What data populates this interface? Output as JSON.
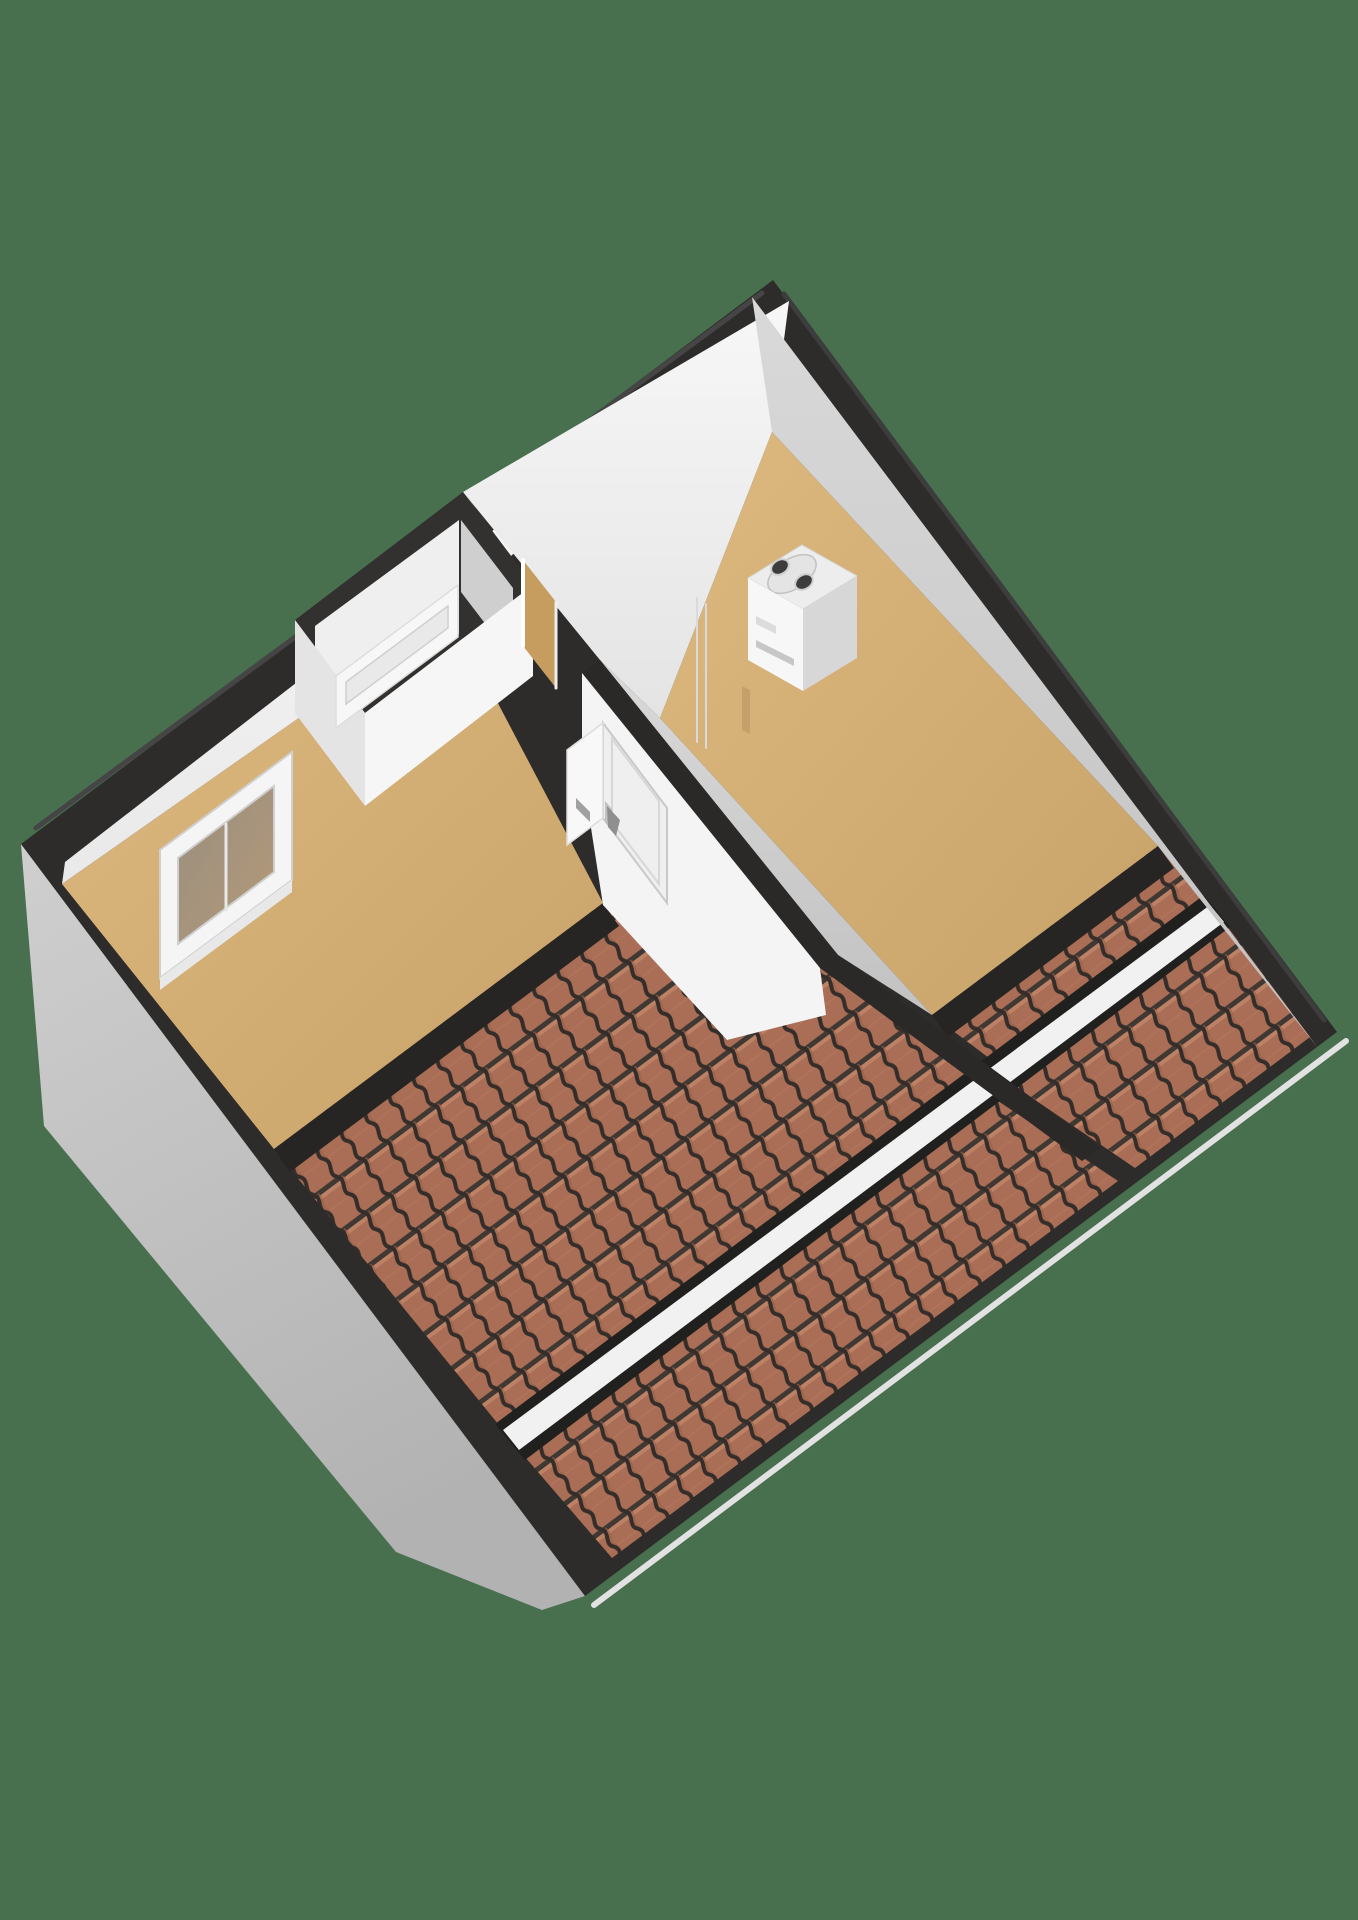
{
  "meta": {
    "description": "3D axonometric attic floor plan render on green background",
    "background_color": "#48704e"
  },
  "palette": {
    "background_green": "#48704e",
    "wall_cut_black": "#2e2c2b",
    "wall_face_white": "#f4f4f4",
    "wall_face_gray": "#cccccc",
    "exterior_gable_gray": "#c2c2c2",
    "floor_tan": "#d3ac72",
    "roof_tile_terracotta": "#a96e55",
    "roof_tile_line_dark": "#342d29",
    "divider_strip_white": "#f1f1f1"
  },
  "objects": [
    {
      "name": "attic-floorplan-3d"
    },
    {
      "name": "sloped-roof-tiled-sections",
      "count": 4
    },
    {
      "name": "left-room-window"
    },
    {
      "name": "stairwell-slot-window"
    },
    {
      "name": "upper-doorway-opening"
    },
    {
      "name": "interior-door",
      "count": 2
    },
    {
      "name": "boiler-unit"
    }
  ],
  "scene": {
    "width": 1358,
    "height": 1920,
    "shapes": [
      {
        "name": "background",
        "type": "rect",
        "x": 0,
        "y": 0,
        "w": 1358,
        "h": 1920,
        "fill": "#48704e"
      },
      {
        "name": "exterior-gable-wall",
        "type": "polygon",
        "fill": "url(#gableGrad)",
        "points": [
          [
            21,
            844
          ],
          [
            585,
            1596
          ],
          [
            542,
            1610
          ],
          [
            396,
            1552
          ],
          [
            44,
            1126
          ]
        ]
      },
      {
        "name": "eave-gutter-line",
        "type": "line",
        "x1": 1346,
        "y1": 1041,
        "x2": 594,
        "y2": 1605,
        "stroke": "#e2e2e2",
        "strokeWidth": 6
      },
      {
        "name": "wall-top-diamond",
        "type": "polygon",
        "fill": "#2e2c2b",
        "points": [
          [
            773,
            280
          ],
          [
            1337,
            1032
          ],
          [
            585,
            1596
          ],
          [
            21,
            844
          ]
        ]
      },
      {
        "name": "ridge-bevel-left",
        "type": "line",
        "x1": 762,
        "y1": 293,
        "x2": 36,
        "y2": 828,
        "stroke": "#454545",
        "strokeWidth": 5
      },
      {
        "name": "ridge-bevel-right",
        "type": "line",
        "x1": 784,
        "y1": 294,
        "x2": 1324,
        "y2": 1020,
        "stroke": "#3d3d3d",
        "strokeWidth": 5
      },
      {
        "name": "right-room-floor",
        "type": "polygon",
        "fill": "url(#floorGrad)",
        "points": [
          [
            772,
            432
          ],
          [
            1158,
            846
          ],
          [
            932,
            1015
          ],
          [
            660,
            718
          ]
        ]
      },
      {
        "name": "left-room-floor",
        "type": "polygon",
        "fill": "url(#floorGrad)",
        "points": [
          [
            450,
            612
          ],
          [
            603,
            903
          ],
          [
            274,
            1149
          ],
          [
            62,
            884
          ]
        ]
      },
      {
        "name": "roof-tiles-right-upper",
        "type": "polygon",
        "fill": "url(#tiles)",
        "points": [
          [
            1158,
            846
          ],
          [
            932,
            1015
          ],
          [
            997,
            1064
          ],
          [
            1210,
            905
          ]
        ]
      },
      {
        "name": "roof-tiles-right-lower",
        "type": "polygon",
        "fill": "url(#tiles)",
        "points": [
          [
            1224,
            922
          ],
          [
            1013,
            1085
          ],
          [
            1135,
            1168
          ],
          [
            1310,
            1037
          ]
        ]
      },
      {
        "name": "roof-tiles-left-upper",
        "type": "polygon",
        "fill": "url(#tiles)",
        "points": [
          [
            603,
            903
          ],
          [
            274,
            1149
          ],
          [
            503,
            1430
          ],
          [
            979,
            1078
          ],
          [
            826,
            962
          ]
        ]
      },
      {
        "name": "roof-tiles-left-lower",
        "type": "polygon",
        "fill": "url(#tiles)",
        "points": [
          [
            995,
            1099
          ],
          [
            519,
            1450
          ],
          [
            612,
            1558
          ],
          [
            1118,
            1181
          ]
        ]
      },
      {
        "name": "roof-strip-shadow",
        "type": "polygon",
        "fill": "#20201f",
        "points": [
          [
            1204,
            895
          ],
          [
            1230,
            927
          ],
          [
            525,
            1460
          ],
          [
            495,
            1424
          ]
        ]
      },
      {
        "name": "roof-divider-strip",
        "type": "polygon",
        "fill": "#f1f1f1",
        "points": [
          [
            1210,
            905
          ],
          [
            1224,
            922
          ],
          [
            519,
            1450
          ],
          [
            503,
            1430
          ]
        ]
      },
      {
        "name": "knee-wall-band-right",
        "type": "polygon",
        "fill": "#262524",
        "points": [
          [
            1158,
            846
          ],
          [
            932,
            1015
          ],
          [
            948,
            1037
          ],
          [
            1174,
            868
          ]
        ]
      },
      {
        "name": "knee-wall-band-left",
        "type": "polygon",
        "fill": "#262524",
        "points": [
          [
            603,
            903
          ],
          [
            274,
            1149
          ],
          [
            290,
            1172
          ],
          [
            619,
            926
          ]
        ]
      },
      {
        "name": "outer-wall-face-left",
        "type": "polygon",
        "fill": "url(#whiteFaceGrad)",
        "points": [
          [
            789,
            301
          ],
          [
            65,
            862
          ],
          [
            62,
            884
          ],
          [
            450,
            612
          ]
        ]
      },
      {
        "name": "upper-wall-face-white",
        "type": "polygon",
        "fill": "url(#whiteFaceGrad2)",
        "points": [
          [
            789,
            301
          ],
          [
            772,
            432
          ],
          [
            660,
            718
          ],
          [
            600,
            660
          ],
          [
            463,
            492
          ]
        ]
      },
      {
        "name": "outer-wall-face-right-gray",
        "type": "polygon",
        "fill": "url(#grayFaceGrad)",
        "points": [
          [
            752,
            297
          ],
          [
            1318,
            1048
          ],
          [
            1158,
            846
          ],
          [
            772,
            432
          ]
        ]
      },
      {
        "name": "dividing-wall-face-right-gray",
        "type": "polygon",
        "fill": "url(#grayFaceGrad)",
        "points": [
          [
            600,
            660
          ],
          [
            838,
            955
          ],
          [
            932,
            1015
          ],
          [
            660,
            718
          ]
        ]
      },
      {
        "name": "dividing-wall-top-band",
        "type": "polygon",
        "fill": "#2a2928",
        "points": [
          [
            600,
            660
          ],
          [
            838,
            955
          ],
          [
            1100,
            1148
          ],
          [
            1082,
            1161
          ],
          [
            820,
            968
          ],
          [
            582,
            673
          ]
        ]
      },
      {
        "name": "dividing-wall-face-left-white",
        "type": "polygon",
        "fill": "#f4f4f4",
        "points": [
          [
            582,
            673
          ],
          [
            820,
            968
          ],
          [
            826,
            1015
          ],
          [
            727,
            1040
          ],
          [
            603,
            905
          ],
          [
            582,
            770
          ]
        ]
      },
      {
        "name": "window-frame",
        "type": "polygon",
        "fill": "#f5f5f5",
        "stroke": "#d0d0d0",
        "strokeWidth": 2,
        "points": [
          [
            160,
            850
          ],
          [
            292,
            752
          ],
          [
            292,
            880
          ],
          [
            160,
            978
          ]
        ]
      },
      {
        "name": "window-glass",
        "type": "polygon",
        "fill": "url(#glassGrad)",
        "stroke": "#cfcfcf",
        "strokeWidth": 2,
        "points": [
          [
            178,
            858
          ],
          [
            274,
            786
          ],
          [
            274,
            872
          ],
          [
            178,
            944
          ]
        ]
      },
      {
        "name": "window-mullion",
        "type": "line",
        "x1": 226,
        "y1": 824,
        "x2": 226,
        "y2": 910,
        "stroke": "#e8e8e8",
        "strokeWidth": 3
      },
      {
        "name": "window-sill",
        "type": "polygon",
        "fill": "#e8e8e8",
        "points": [
          [
            160,
            978
          ],
          [
            292,
            880
          ],
          [
            292,
            892
          ],
          [
            160,
            990
          ]
        ]
      },
      {
        "name": "stairwell-wall-top-ring",
        "type": "polygon",
        "fill": "#323130",
        "points": [
          [
            463,
            492
          ],
          [
            533,
            585
          ],
          [
            365,
            713
          ],
          [
            295,
            620
          ]
        ]
      },
      {
        "name": "stairwell-inner-face-bright",
        "type": "polygon",
        "fill": "#efefef",
        "points": [
          [
            459,
            520
          ],
          [
            315,
            626
          ],
          [
            315,
            740
          ],
          [
            459,
            634
          ]
        ]
      },
      {
        "name": "stairwell-inner-face-shaded",
        "type": "polygon",
        "fill": "#cfcfcf",
        "points": [
          [
            461,
            520
          ],
          [
            513,
            588
          ],
          [
            513,
            660
          ],
          [
            461,
            592
          ]
        ]
      },
      {
        "name": "stairwell-front-face-left",
        "type": "polygon",
        "fill": "#e4e4e4",
        "points": [
          [
            295,
            620
          ],
          [
            365,
            713
          ],
          [
            365,
            806
          ],
          [
            295,
            713
          ]
        ]
      },
      {
        "name": "stairwell-front-face-right",
        "type": "polygon",
        "fill": "#f6f6f6",
        "points": [
          [
            365,
            713
          ],
          [
            533,
            585
          ],
          [
            533,
            676
          ],
          [
            365,
            806
          ]
        ]
      },
      {
        "name": "slot-window-frame",
        "type": "polygon",
        "fill": "#f7f7f7",
        "stroke": "#dddddd",
        "strokeWidth": 1.5,
        "points": [
          [
            336,
            676
          ],
          [
            458,
            585
          ],
          [
            458,
            637
          ],
          [
            336,
            728
          ]
        ]
      },
      {
        "name": "slot-window-glass",
        "type": "polygon",
        "fill": "#e9e9e9",
        "stroke": "#cfcfcf",
        "strokeWidth": 1.5,
        "points": [
          [
            346,
            682
          ],
          [
            448,
            606
          ],
          [
            448,
            628
          ],
          [
            346,
            704
          ]
        ]
      },
      {
        "name": "doorway-opening",
        "type": "polygon",
        "fill": "#c69d5f",
        "points": [
          [
            523,
            560
          ],
          [
            556,
            602
          ],
          [
            556,
            688
          ],
          [
            523,
            646
          ]
        ]
      },
      {
        "name": "doorway-jamb-left",
        "type": "line",
        "x1": 523,
        "y1": 560,
        "x2": 523,
        "y2": 646,
        "stroke": "#ffffff",
        "strokeWidth": 4
      },
      {
        "name": "doorway-jamb-right",
        "type": "line",
        "x1": 556,
        "y1": 602,
        "x2": 556,
        "y2": 688,
        "stroke": "#eeeeee",
        "strokeWidth": 3
      },
      {
        "name": "door-right",
        "type": "polygon",
        "fill": "#efefef",
        "stroke": "#c9c9c9",
        "strokeWidth": 2,
        "points": [
          [
            603,
            723
          ],
          [
            667,
            808
          ],
          [
            667,
            903
          ],
          [
            603,
            818
          ]
        ]
      },
      {
        "name": "door-right-panel",
        "type": "polygon",
        "fill": "none",
        "stroke": "#d7d7d7",
        "strokeWidth": 2,
        "points": [
          [
            612,
            739
          ],
          [
            659,
            801
          ],
          [
            659,
            884
          ],
          [
            612,
            822
          ]
        ]
      },
      {
        "name": "door-right-handle-plate",
        "type": "polygon",
        "fill": "#c0c0c0",
        "points": [
          [
            605,
            801
          ],
          [
            612,
            809
          ],
          [
            612,
            830
          ],
          [
            605,
            822
          ]
        ]
      },
      {
        "name": "door-right-handle",
        "type": "polygon",
        "fill": "#8f8f8f",
        "points": [
          [
            607,
            806
          ],
          [
            620,
            820
          ],
          [
            616,
            836
          ],
          [
            608,
            827
          ]
        ]
      },
      {
        "name": "door-left",
        "type": "polygon",
        "fill": "#f8f8f8",
        "stroke": "#dddddd",
        "strokeWidth": 1.5,
        "points": [
          [
            603,
            723
          ],
          [
            567,
            750
          ],
          [
            567,
            845
          ],
          [
            603,
            818
          ]
        ]
      },
      {
        "name": "door-left-handle",
        "type": "polygon",
        "fill": "#a0a0a0",
        "points": [
          [
            576,
            798
          ],
          [
            590,
            812
          ],
          [
            590,
            822
          ],
          [
            576,
            808
          ]
        ]
      },
      {
        "name": "boiler-top",
        "type": "polygon",
        "fill": "#ededed",
        "stroke": "#d5d5d5",
        "strokeWidth": 1,
        "points": [
          [
            748,
            578
          ],
          [
            802,
            545
          ],
          [
            857,
            576
          ],
          [
            803,
            609
          ]
        ]
      },
      {
        "name": "boiler-flue-plate",
        "type": "ellipse",
        "cx": 792,
        "cy": 574,
        "rx": 27,
        "ry": 15,
        "rotate": -33,
        "fill": "#e4e4e4",
        "stroke": "#c2c2c2",
        "strokeWidth": 1.5
      },
      {
        "name": "boiler-flue-a",
        "type": "ellipse",
        "cx": 780,
        "cy": 567,
        "rx": 9.5,
        "ry": 7,
        "rotate": -33,
        "fill": "#3c3c3c",
        "stroke": "#cfcfcf",
        "strokeWidth": 2
      },
      {
        "name": "boiler-flue-b",
        "type": "ellipse",
        "cx": 804,
        "cy": 582,
        "rx": 9.5,
        "ry": 7,
        "rotate": -33,
        "fill": "#3c3c3c",
        "stroke": "#cfcfcf",
        "strokeWidth": 2
      },
      {
        "name": "boiler-front-face",
        "type": "polygon",
        "fill": "#f7f7f7",
        "points": [
          [
            748,
            578
          ],
          [
            803,
            609
          ],
          [
            803,
            691
          ],
          [
            748,
            660
          ]
        ]
      },
      {
        "name": "boiler-side-face",
        "type": "polygon",
        "fill": "#d7d7d7",
        "points": [
          [
            803,
            609
          ],
          [
            857,
            576
          ],
          [
            857,
            658
          ],
          [
            803,
            691
          ]
        ]
      },
      {
        "name": "boiler-badge",
        "type": "polygon",
        "fill": "#dcdcdc",
        "points": [
          [
            756,
            616
          ],
          [
            776,
            626
          ],
          [
            776,
            634
          ],
          [
            756,
            624
          ]
        ]
      },
      {
        "name": "boiler-vent",
        "type": "polygon",
        "fill": "#c7c7c7",
        "points": [
          [
            756,
            640
          ],
          [
            794,
            659
          ],
          [
            794,
            666
          ],
          [
            756,
            647
          ]
        ]
      },
      {
        "name": "boiler-pipe",
        "type": "polygon",
        "fill": "#c6a06b",
        "points": [
          [
            742,
            686
          ],
          [
            750,
            690
          ],
          [
            750,
            734
          ],
          [
            742,
            730
          ]
        ]
      },
      {
        "name": "wall-seam-a",
        "type": "line",
        "x1": 697,
        "y1": 598,
        "x2": 697,
        "y2": 742,
        "stroke": "#dadada",
        "strokeWidth": 2
      },
      {
        "name": "wall-seam-b",
        "type": "line",
        "x1": 706,
        "y1": 604,
        "x2": 706,
        "y2": 748,
        "stroke": "#dadada",
        "strokeWidth": 2
      }
    ]
  }
}
